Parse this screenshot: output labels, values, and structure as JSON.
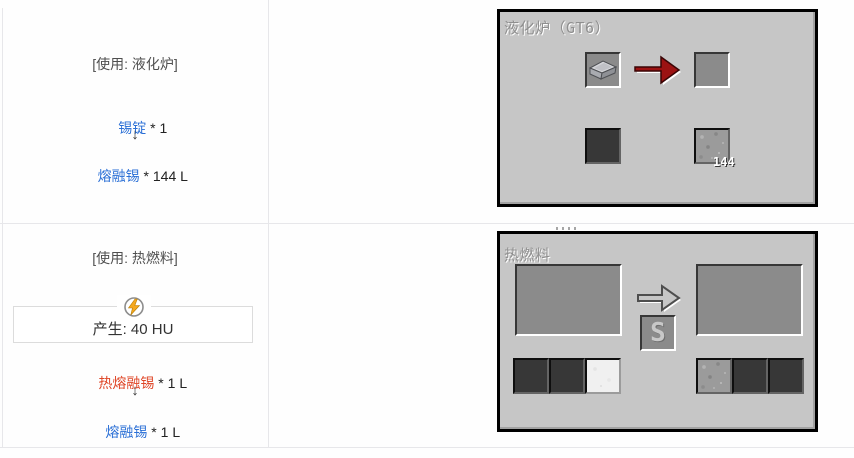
{
  "colors": {
    "link_blue": "#2a6fd6",
    "link_red": "#df4526",
    "panel_background": "#c6c6c6",
    "slot_background": "#8b8b8b",
    "arrow_red": "#9c1212",
    "energy_bolt_yellow": "#f6a81c",
    "grid_line": "#e7e7ea"
  },
  "icons": {
    "energy": "lightning-icon",
    "recipe_arrow_top": "red-right-arrow-icon",
    "recipe_arrow_bottom": "gray-right-arrow-icon",
    "item": "tin-ingot-icon"
  },
  "rows": [
    {
      "usage_label": "[使用: 液化炉]",
      "input_link": "锡锭",
      "input_suffix": " * 1",
      "down_arrow": "↓",
      "output_link": "熔融锡",
      "output_suffix": " * 144 L",
      "gui": {
        "title": "液化炉（GT6）",
        "fluid_amount": "144"
      }
    },
    {
      "usage_label": "[使用: 热燃料]",
      "energy_label": "产生: 40 HU",
      "input_link": "热熔融锡",
      "input_suffix": " * 1 L",
      "down_arrow": "↓",
      "output_link": "熔融锡",
      "output_suffix": " * 1 L",
      "gui": {
        "title": "热燃料",
        "s_label": "S"
      }
    }
  ]
}
